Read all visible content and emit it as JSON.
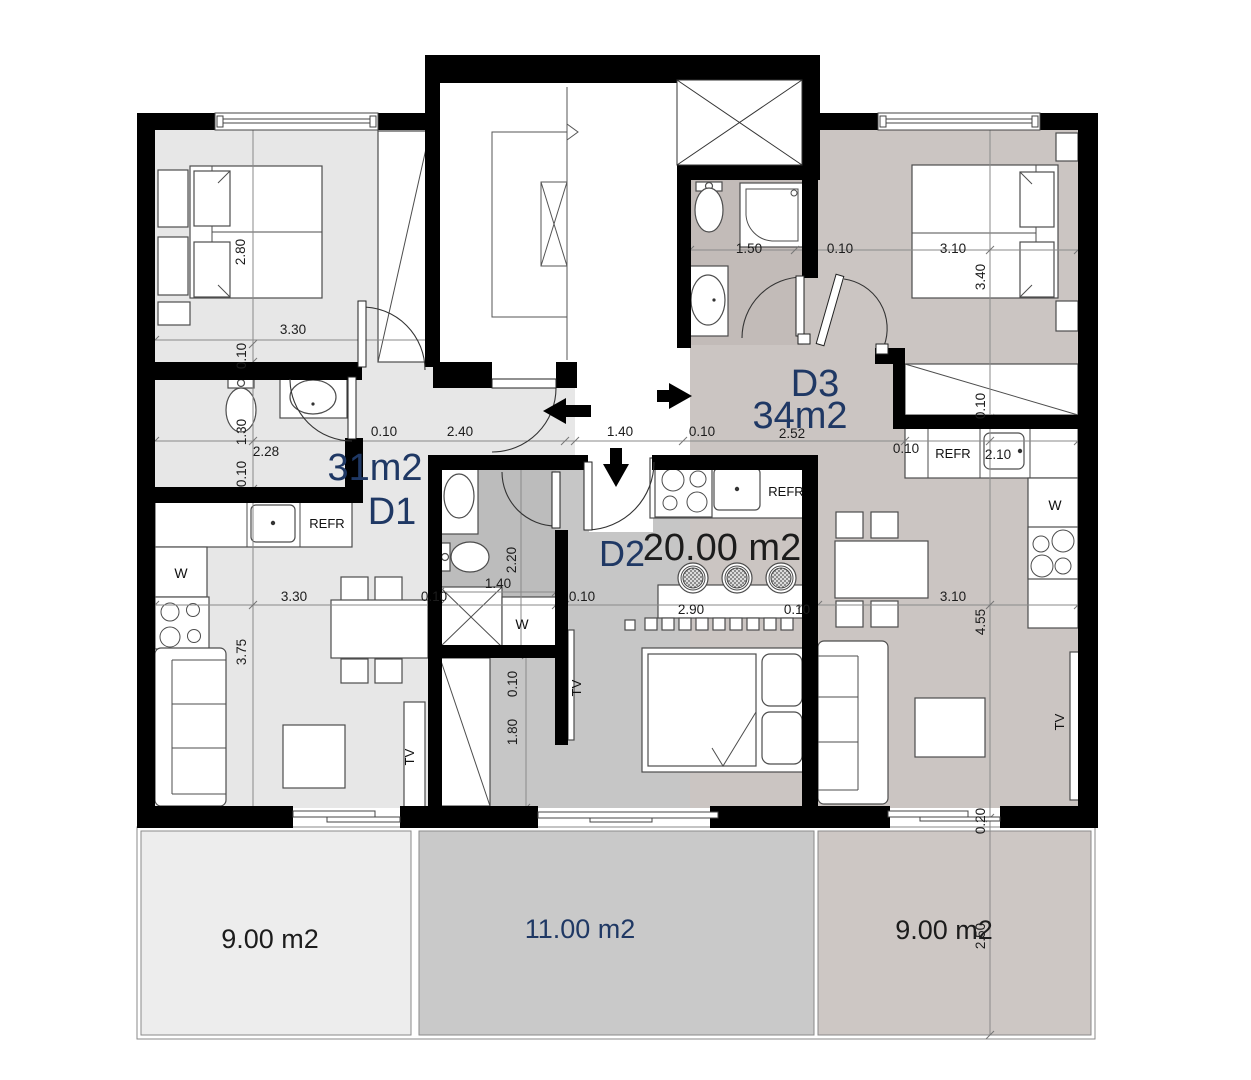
{
  "plan_title": "Apartment floor plan",
  "units": {
    "d1": {
      "id": "D1",
      "area": "31m2"
    },
    "d2": {
      "id": "D2",
      "area": "20.00 m2"
    },
    "d3": {
      "id": "D3",
      "area": "34m2"
    }
  },
  "terraces": {
    "left": "9.00 m2",
    "center": "11.00 m2",
    "right": "9.00 m2"
  },
  "labels": {
    "refrigerator": "REFR",
    "washer": "W",
    "tv": "TV"
  },
  "dimension_labels": [
    {
      "t": "2.80",
      "x": 245,
      "y": 252,
      "v": true
    },
    {
      "t": "3.30",
      "x": 293,
      "y": 334,
      "v": false
    },
    {
      "t": "0.10",
      "x": 246,
      "y": 356,
      "v": true
    },
    {
      "t": "1.30",
      "x": 246,
      "y": 432,
      "v": true
    },
    {
      "t": "0.10",
      "x": 246,
      "y": 474,
      "v": true
    },
    {
      "t": "3.75",
      "x": 246,
      "y": 652,
      "v": true
    },
    {
      "t": "2.28",
      "x": 266,
      "y": 456,
      "v": false
    },
    {
      "t": "0.10",
      "x": 384,
      "y": 436,
      "v": false
    },
    {
      "t": "2.40",
      "x": 460,
      "y": 436,
      "v": false
    },
    {
      "t": "1.40",
      "x": 620,
      "y": 436,
      "v": false
    },
    {
      "t": "0.10",
      "x": 702,
      "y": 436,
      "v": false
    },
    {
      "t": "2.52",
      "x": 792,
      "y": 438,
      "v": false
    },
    {
      "t": "0.10",
      "x": 906,
      "y": 453,
      "v": false
    },
    {
      "t": "2.10",
      "x": 998,
      "y": 459,
      "v": false
    },
    {
      "t": "1.50",
      "x": 749,
      "y": 253,
      "v": false
    },
    {
      "t": "0.10",
      "x": 840,
      "y": 253,
      "v": false
    },
    {
      "t": "3.10",
      "x": 953,
      "y": 253,
      "v": false
    },
    {
      "t": "3.30",
      "x": 294,
      "y": 601,
      "v": false
    },
    {
      "t": "0.10",
      "x": 434,
      "y": 601,
      "v": false
    },
    {
      "t": "0.10",
      "x": 582,
      "y": 601,
      "v": false
    },
    {
      "t": "2.90",
      "x": 691,
      "y": 614,
      "v": false
    },
    {
      "t": "0.10",
      "x": 797,
      "y": 614,
      "v": false
    },
    {
      "t": "3.10",
      "x": 953,
      "y": 601,
      "v": false
    },
    {
      "t": "3.40",
      "x": 985,
      "y": 277,
      "v": true
    },
    {
      "t": "0.10",
      "x": 985,
      "y": 406,
      "v": true
    },
    {
      "t": "4.55",
      "x": 985,
      "y": 622,
      "v": true
    },
    {
      "t": "0.20",
      "x": 985,
      "y": 821,
      "v": true
    },
    {
      "t": "2.50",
      "x": 985,
      "y": 936,
      "v": true
    },
    {
      "t": "2.20",
      "x": 516,
      "y": 560,
      "v": true
    },
    {
      "t": "1.40",
      "x": 498,
      "y": 588,
      "v": false
    },
    {
      "t": "0.10",
      "x": 517,
      "y": 684,
      "v": true
    },
    {
      "t": "1.80",
      "x": 517,
      "y": 732,
      "v": true
    }
  ],
  "colors": {
    "wall": "#000000",
    "accent": "#1f3864",
    "ink": "#1c1c1c",
    "line": "#8a8a8a",
    "furniture_stroke": "#4d4d4d",
    "d1_fill": "#e7e7e7",
    "d2_fill": "#c6c6c6",
    "d2_bath_fill": "#bcbcbc",
    "d3_fill": "#cbc5c2",
    "d3_bath_fill": "#c2bbb8",
    "corridor_fill": "#ffffff",
    "terrace_left_fill": "#ededed",
    "terrace_center_fill": "#c9c9c9",
    "terrace_right_fill": "#cdc7c4"
  }
}
